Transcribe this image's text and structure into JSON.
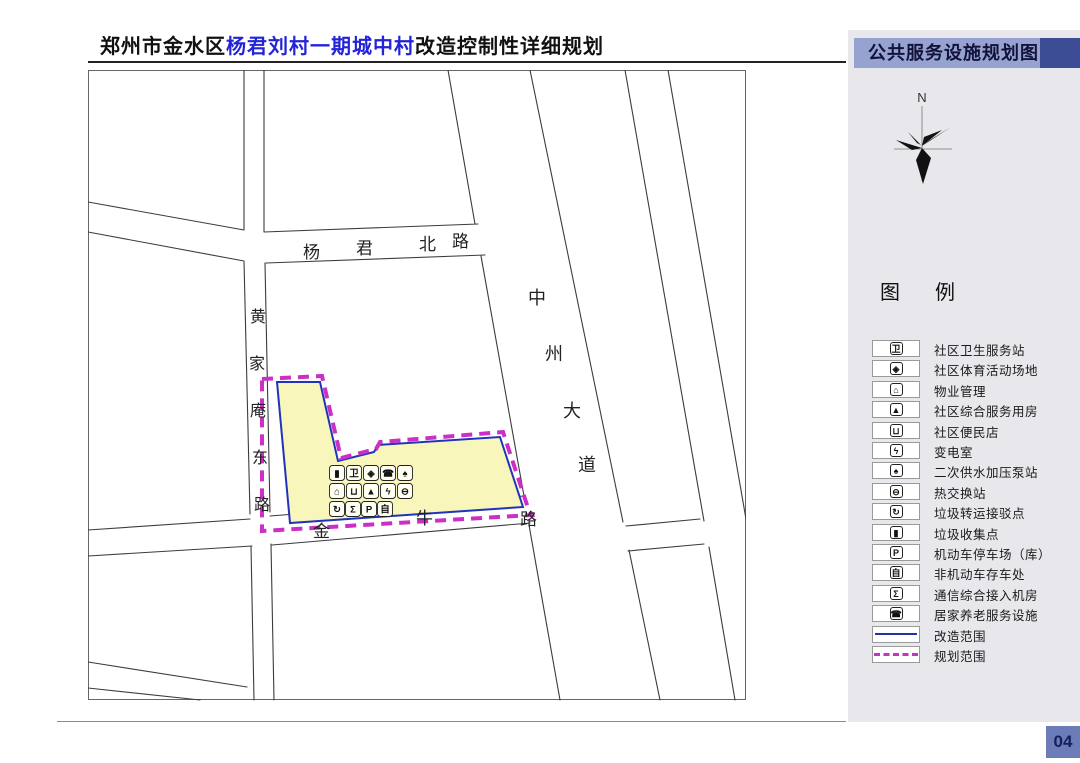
{
  "header": {
    "title_parts": [
      {
        "text": "郑州市金水区",
        "blue": false
      },
      {
        "text": "杨君刘村一期城中村",
        "blue": true
      },
      {
        "text": "改造控制性详细规划",
        "blue": false
      }
    ],
    "blue_color": "#2323d8"
  },
  "map": {
    "road_labels": [
      {
        "id": "yangjun-north-road",
        "text": "杨君北路"
      },
      {
        "id": "huangjiaan-east-road",
        "text": "黄家庵东路"
      },
      {
        "id": "zhongzhou-avenue",
        "text": "中州大道"
      },
      {
        "id": "jinniu-road",
        "text": "金牛路"
      }
    ],
    "parcel_icon_rows": [
      [
        {
          "glyph": "▮",
          "name": "garbage-collection-icon"
        },
        {
          "glyph": "卫",
          "name": "health-station-icon"
        },
        {
          "glyph": "◈",
          "name": "sports-ground-icon"
        },
        {
          "glyph": "☎",
          "name": "elderly-care-icon"
        },
        {
          "glyph": "♠",
          "name": "water-pump-icon"
        }
      ],
      [
        {
          "glyph": "⌂",
          "name": "property-mgmt-icon"
        },
        {
          "glyph": "⊔",
          "name": "convenience-store-icon"
        },
        {
          "glyph": "▲",
          "name": "community-service-icon"
        },
        {
          "glyph": "ϟ",
          "name": "transformer-icon"
        },
        {
          "glyph": "⊖",
          "name": "heat-exchange-icon"
        }
      ],
      [
        {
          "glyph": "↻",
          "name": "garbage-transfer-icon"
        },
        {
          "glyph": "Σ",
          "name": "telecom-room-icon"
        },
        {
          "glyph": "P",
          "name": "parking-icon"
        },
        {
          "glyph": "自",
          "name": "bike-parking-icon"
        }
      ]
    ],
    "boundary_colors": {
      "renovation": "#2233bb",
      "planning": "#cb2fc6",
      "parcel_fill": "#f9f6bb"
    }
  },
  "panel": {
    "title": "公共服务设施规划图",
    "north_label": "N",
    "legend_title": "图 例",
    "legend_items": [
      {
        "kind": "icon",
        "glyph": "卫",
        "name": "health-station",
        "label": "社区卫生服务站"
      },
      {
        "kind": "icon",
        "glyph": "◈",
        "name": "sports-ground",
        "label": "社区体育活动场地"
      },
      {
        "kind": "icon",
        "glyph": "⌂",
        "name": "property-mgmt",
        "label": "物业管理"
      },
      {
        "kind": "icon",
        "glyph": "▲",
        "name": "community-service",
        "label": "社区综合服务用房"
      },
      {
        "kind": "icon",
        "glyph": "⊔",
        "name": "convenience-store",
        "label": "社区便民店"
      },
      {
        "kind": "icon",
        "glyph": "ϟ",
        "name": "transformer",
        "label": "变电室"
      },
      {
        "kind": "icon",
        "glyph": "♠",
        "name": "water-pump",
        "label": "二次供水加压泵站"
      },
      {
        "kind": "icon",
        "glyph": "⊖",
        "name": "heat-exchange",
        "label": "热交换站"
      },
      {
        "kind": "icon",
        "glyph": "↻",
        "name": "garbage-transfer",
        "label": "垃圾转运接驳点"
      },
      {
        "kind": "icon",
        "glyph": "▮",
        "name": "garbage-collection",
        "label": "垃圾收集点"
      },
      {
        "kind": "icon",
        "glyph": "P",
        "name": "parking",
        "label": "机动车停车场（库）"
      },
      {
        "kind": "icon",
        "glyph": "自",
        "name": "bike-parking",
        "label": "非机动车存车处"
      },
      {
        "kind": "icon",
        "glyph": "Σ",
        "name": "telecom-room",
        "label": "通信综合接入机房"
      },
      {
        "kind": "icon",
        "glyph": "☎",
        "name": "elderly-care",
        "label": "居家养老服务设施"
      },
      {
        "kind": "line-solid",
        "name": "renovation-boundary",
        "label": "改造范围"
      },
      {
        "kind": "line-dashed",
        "name": "planning-boundary",
        "label": "规划范围"
      }
    ],
    "page_number": "04"
  }
}
